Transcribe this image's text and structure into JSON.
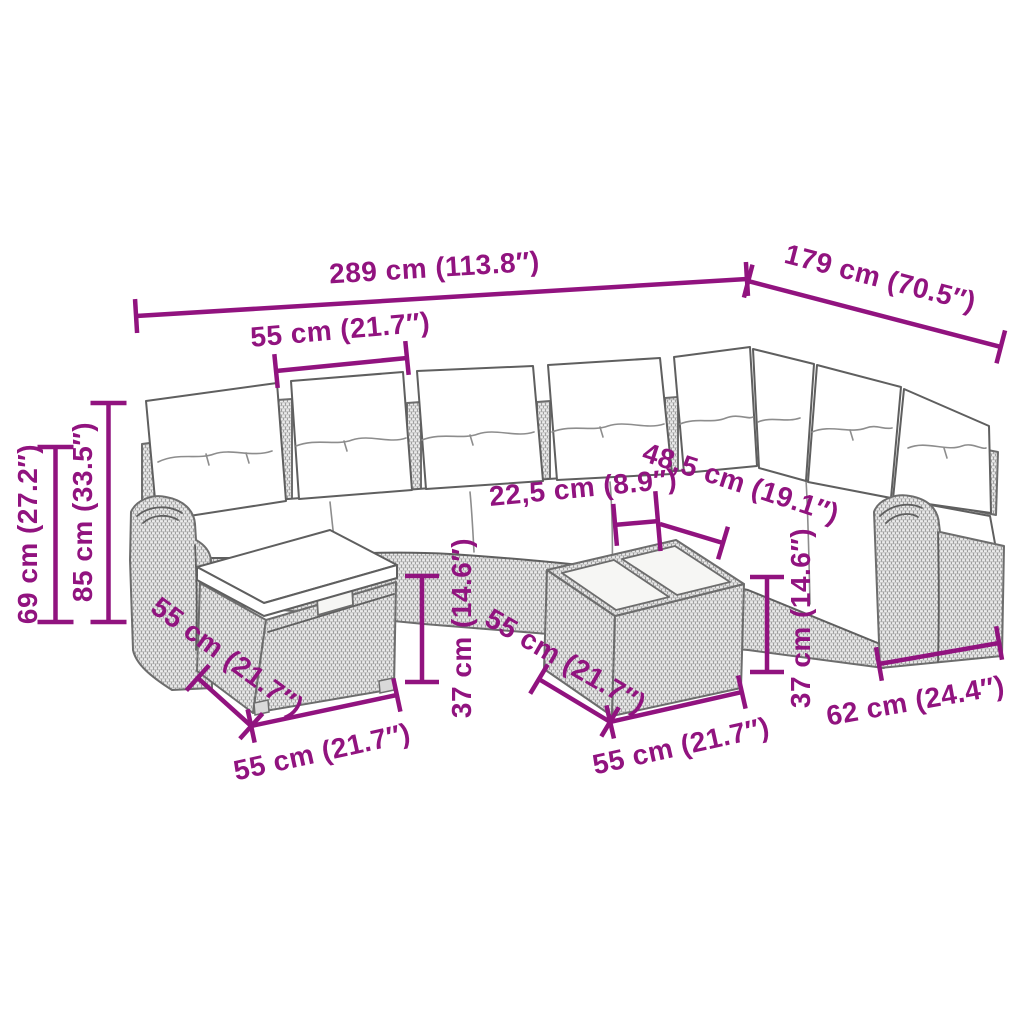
{
  "accent_color": "#91137F",
  "background_color": "#FFFFFF",
  "illustration": {
    "subject": "9-piece rattan garden lounge set with cushions",
    "style": "grayscale line drawing with woven wicker texture",
    "pieces": [
      "corner sofa with back cushions",
      "storage footstool with cushion",
      "coffee table with two glass tops",
      "left scroll armrest",
      "right scroll armrest"
    ]
  },
  "dims": {
    "overall_width": {
      "label": "289 cm (113.8″)"
    },
    "overall_depth": {
      "label": "179 cm (70.5″)"
    },
    "back_cushion_width": {
      "label": "55 cm (21.7″)"
    },
    "seat_back_height": {
      "label": "69 cm (27.2″)"
    },
    "total_height": {
      "label": "85 cm (33.5″)"
    },
    "sofa_to_table_gap": {
      "label": "22,5 cm (8.9″)"
    },
    "corner_to_table_gap": {
      "label": "48,5 cm (19.1″)"
    },
    "footstool_depth": {
      "label": "55 cm (21.7″)"
    },
    "footstool_width": {
      "label": "55 cm (21.7″)"
    },
    "footstool_height": {
      "label": "37 cm (14.6″)"
    },
    "table_depth": {
      "label": "55 cm (21.7″)"
    },
    "table_width": {
      "label": "55 cm (21.7″)"
    },
    "table_height": {
      "label": "37 cm (14.6″)"
    },
    "armrest_section_width": {
      "label": "62 cm (24.4″)"
    }
  }
}
